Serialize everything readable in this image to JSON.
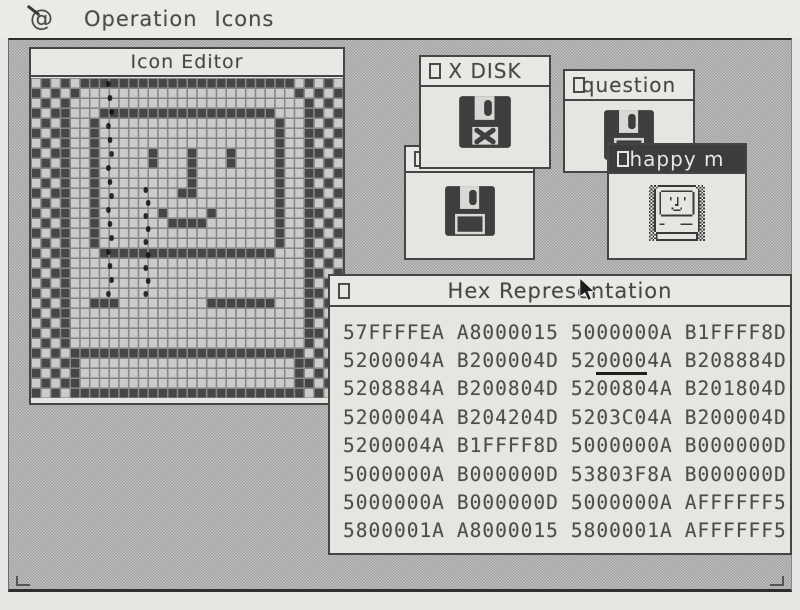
{
  "menu_bar": {
    "apple_logo": "@",
    "items": [
      {
        "label": "Operation"
      },
      {
        "label": "Icons"
      }
    ]
  },
  "windows": {
    "icon_editor": {
      "title": "Icon Editor"
    },
    "x_disk": {
      "title": "X DISK"
    },
    "question": {
      "title": "question"
    },
    "happy_m": {
      "title": "happy m"
    },
    "hex": {
      "title": "Hex Representation",
      "rows": [
        [
          "57FFFFEA",
          "A8000015",
          "5000000A",
          "B1FFFF8D"
        ],
        [
          "5200004A",
          "B200004D",
          "5200004A",
          "B208884D"
        ],
        [
          "5208884A",
          "B200804D",
          "5200804A",
          "B201804D"
        ],
        [
          "5200004A",
          "B204204D",
          "5203C04A",
          "B200004D"
        ],
        [
          "5200004A",
          "B1FFFF8D",
          "5000000A",
          "B000000D"
        ],
        [
          "5000000A",
          "B000000D",
          "53803F8A",
          "B000000D"
        ],
        [
          "5000000A",
          "B000000D",
          "5000000A",
          "AFFFFFF5"
        ],
        [
          "5800001A",
          "A8000015",
          "5800001A",
          "AFFFFFF5"
        ]
      ],
      "underline": {
        "row": 1,
        "col": 2,
        "start": 2,
        "end": 6
      }
    }
  },
  "icons": {
    "x_disk_icon": "floppy-disk-with-x",
    "question_icon": "floppy-disk",
    "hidden_icon": "floppy-disk",
    "happy_icon": "happy-mac",
    "cursor": "arrow-pointer"
  },
  "colors": {
    "desktop_dark": "#9d9d9d",
    "desktop_light": "#c3c3c3",
    "ink": "#454545",
    "paper": "#e8e7e3",
    "window_bg": "#e6e5e1",
    "pixel_on": "#464646",
    "pixel_off": "#cbcbca",
    "grid_line": "#878787"
  }
}
